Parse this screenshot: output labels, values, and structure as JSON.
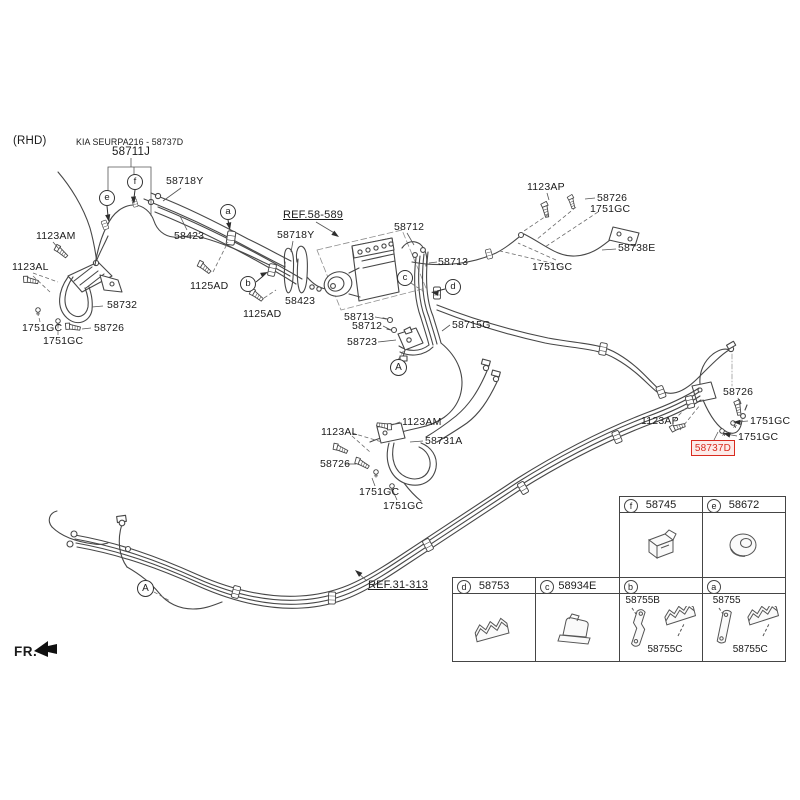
{
  "page": {
    "variant_label": "(RHD)",
    "front_label": "FR.",
    "kit_banner": {
      "title": "KIA SEURPA216 - 58737D",
      "part": "58711J"
    },
    "references": {
      "abs_unit": "REF.58-589",
      "front_tubes": "REF.31-313"
    },
    "highlighted_part": {
      "number": "58737D",
      "color": "#d92b1f"
    }
  },
  "callouts": {
    "a": "a",
    "b": "b",
    "c": "c",
    "d": "d",
    "e": "e",
    "f": "f",
    "section": "A"
  },
  "parts": {
    "tube_58718y_left": "58718Y",
    "bolt_1123am_front": "1123AM",
    "tube_58423_left": "58423",
    "bolt_1123al_front": "1123AL",
    "tube_58718y_abs": "58718Y",
    "bolt_1125ad_1": "1125AD",
    "bolt_1125ad_2": "1125AD",
    "tube_58423_abs": "58423",
    "hose_front_left": "58732",
    "clip_1751gc_front_1": "1751GC",
    "bolt_58726_front": "58726",
    "clip_1751gc_front_2": "1751GC",
    "tube_58712_upper": "58712",
    "tube_58713_upper": "58713",
    "tube_58713_lower": "58713",
    "tube_58712_lower": "58712",
    "valve_58723": "58723",
    "tube_58715g": "58715G",
    "bolt_1123ap_upper": "1123AP",
    "bolt_58726_upper": "58726",
    "clip_1751gc_upper_1": "1751GC",
    "clip_1751gc_upper_2": "1751GC",
    "hose_58738e": "58738E",
    "bolt_1123am_center": "1123AM",
    "bolt_1123al_center": "1123AL",
    "hose_58731a": "58731A",
    "bolt_58726_center": "58726",
    "clip_1751gc_center_1": "1751GC",
    "clip_1751gc_center_2": "1751GC",
    "bolt_1123ap_rear": "1123AP",
    "bolt_58726_rear": "58726",
    "clip_1751gc_rear_1": "1751GC",
    "clip_1751gc_rear_2": "1751GC"
  },
  "legend": {
    "cells": [
      {
        "letter": "f",
        "part": "58745",
        "items": []
      },
      {
        "letter": "e",
        "part": "58672",
        "items": []
      },
      {
        "letter": "d",
        "part": "58753",
        "items": []
      },
      {
        "letter": "c",
        "part": "58934E",
        "items": []
      },
      {
        "letter": "b",
        "part": "",
        "items": [
          "58755B",
          "58755C"
        ]
      },
      {
        "letter": "a",
        "part": "",
        "items": [
          "58755",
          "58755C"
        ]
      }
    ]
  }
}
